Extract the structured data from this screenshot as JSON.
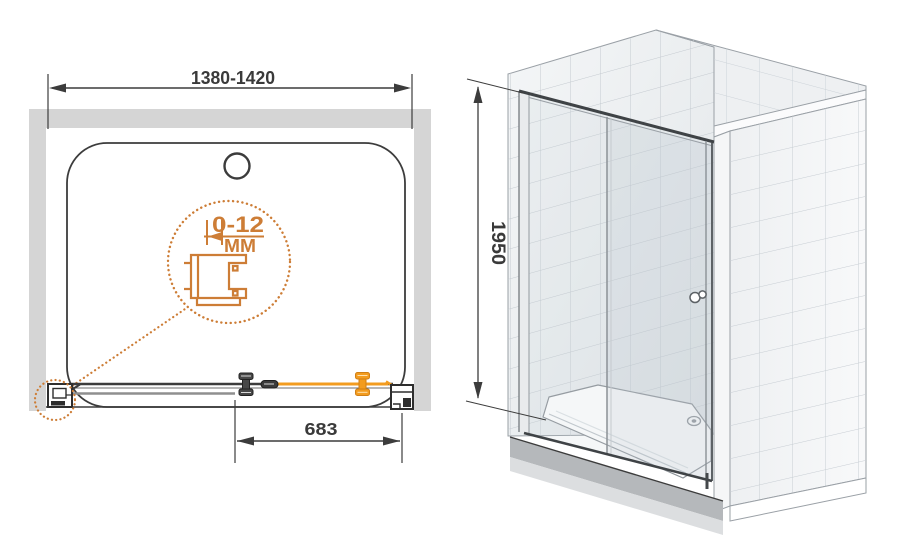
{
  "figure_left": {
    "name": "plan-view-technical-drawing",
    "width_dimension_label": "1380-1420",
    "adjustment_range_label": "0-12",
    "adjustment_unit_label": "MM",
    "door_dimension_label": "683"
  },
  "figure_right": {
    "name": "isometric-view-shower-enclosure",
    "height_dimension_label": "1950"
  },
  "colors": {
    "accent_orange": "#cd7d36",
    "highlight_orange": "#f39c1f",
    "line_dark": "#3c3c3c",
    "wall_gray": "#d5d5d5",
    "tile_grout": "#c4cad0",
    "plinth_gray": "#b5b8bb"
  }
}
